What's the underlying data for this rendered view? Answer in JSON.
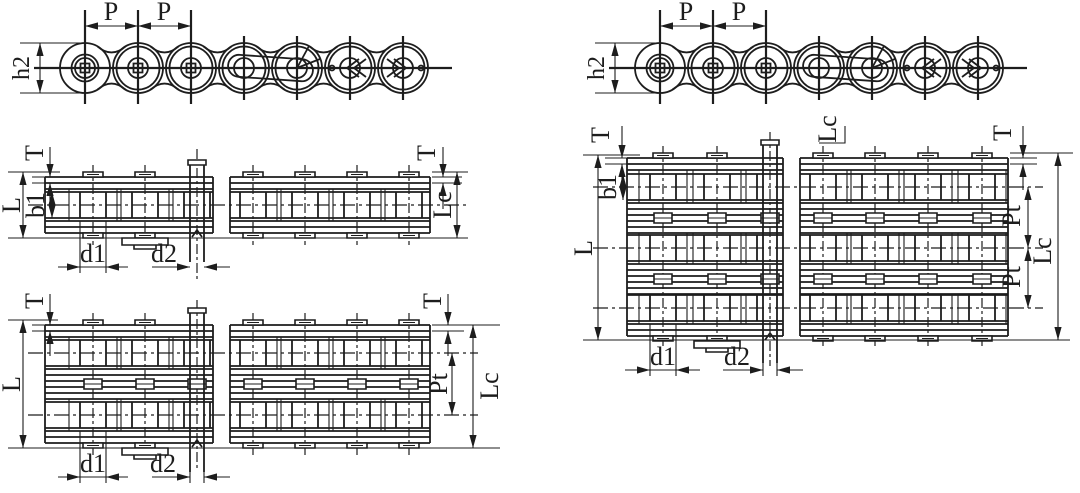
{
  "diagram": {
    "background_color": "#ffffff",
    "line_color": "#1d1d1d",
    "panels": {
      "side_view_left": {
        "labels": {
          "pitch_a": "P",
          "pitch_b": "P",
          "height": "h2"
        }
      },
      "side_view_right": {
        "labels": {
          "pitch_a": "P",
          "pitch_b": "P",
          "height": "h2"
        }
      },
      "simplex_plan": {
        "labels": {
          "plate_thickness_left": "T",
          "plate_thickness_right": "T",
          "pin_length": "L",
          "inner_width": "b1",
          "roller_diameter": "d1",
          "pin_diameter": "d2",
          "connecting_length": "Lc"
        }
      },
      "duplex_plan": {
        "labels": {
          "plate_thickness_left": "T",
          "plate_thickness_right": "T",
          "pin_length": "L",
          "roller_diameter": "d1",
          "pin_diameter": "d2",
          "transverse_pitch": "Pt",
          "connecting_length": "Lc"
        }
      },
      "triplex_plan": {
        "labels": {
          "plate_thickness_left": "T",
          "plate_thickness_right": "T",
          "pin_length": "L",
          "inner_width": "b1",
          "roller_diameter": "d1",
          "pin_diameter": "d2",
          "transverse_pitch_upper": "Pt",
          "transverse_pitch_lower": "Pt",
          "connecting_length_top": "Lc",
          "connecting_length_right": "Lc"
        }
      }
    }
  }
}
